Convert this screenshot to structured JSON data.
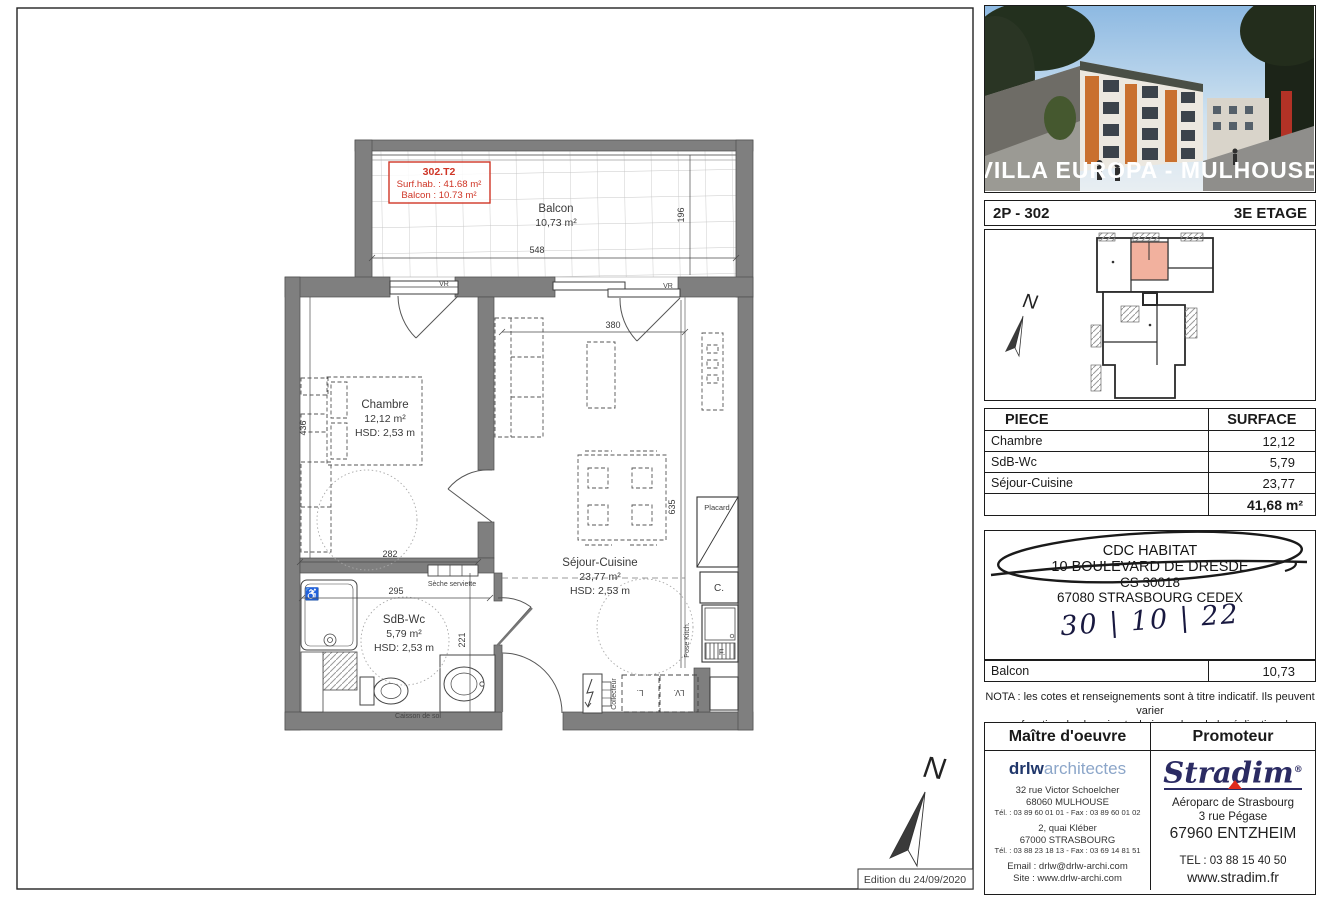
{
  "page": {
    "edition": "Edition du 24/09/2020"
  },
  "plan": {
    "tag": {
      "line1": "302.T2",
      "line2": "Surf.hab. : 41.68 m²",
      "line3": "Balcon : 10.73 m²"
    },
    "rooms": {
      "balcon": {
        "name": "Balcon",
        "area": "10,73 m²"
      },
      "chambre": {
        "name": "Chambre",
        "area": "12,12 m²",
        "hsd": "HSD: 2,53 m"
      },
      "sejour": {
        "name": "Séjour-Cuisine",
        "area": "23,77 m²",
        "hsd": "HSD: 2,53 m"
      },
      "sdb": {
        "name": "SdB-Wc",
        "area": "5,79 m²",
        "hsd": "HSD: 2,53 m"
      }
    },
    "dims": {
      "balcon_w": "548",
      "balcon_d": "196",
      "sejour_w": "380",
      "sejour_d": "635",
      "chambre_w": "282",
      "chambre_d": "436",
      "sdb_w": "295",
      "sdb_d": "221"
    },
    "labels": {
      "seche_serviette": "Sèche serviette",
      "caisson": "Caisson de sol",
      "placard": "Placard",
      "c": "C.",
      "f": "F.",
      "pose_kitch": "Pose Kitch.",
      "collecteur": "Collecteur",
      "l": "L.",
      "lv": "LV.",
      "vr": "VR",
      "north": "N"
    }
  },
  "sidebar": {
    "photo_caption": "VILLA EUROPA - MULHOUSE",
    "unit": {
      "ref": "2P - 302",
      "floor": "3E ETAGE"
    },
    "surface_table": {
      "col_piece": "PIECE",
      "col_surface": "SURFACE",
      "rows": [
        {
          "piece": "Chambre",
          "surface": "12,12"
        },
        {
          "piece": "SdB-Wc",
          "surface": "5,79"
        },
        {
          "piece": "Séjour-Cuisine",
          "surface": "23,77"
        }
      ],
      "total": "41,68 m²"
    },
    "stamp": {
      "line1": "CDC HABITAT",
      "line2": "10 BOULEVARD DE DRESDE",
      "line3": "CS 30018",
      "line4": "67080 STRASBOURG CEDEX",
      "handwritten_date": "30 | 10 | 22"
    },
    "balcon_row": {
      "label": "Balcon",
      "value": "10,73"
    },
    "nota": {
      "line1": "NOTA : les cotes et renseignements sont à titre indicatif. Ils peuvent varier",
      "line2": "en fonction des besoins techniques lors de la réalisation du bâtiment."
    },
    "contractors": {
      "maitre_header": "Maître d'oeuvre",
      "promoteur_header": "Promoteur",
      "drlw": {
        "logo_bold": "drlw",
        "logo_light": "architectes",
        "addr1_l1": "32 rue Victor Schoelcher",
        "addr1_l2": "68060 MULHOUSE",
        "addr1_tel": "Tél. : 03 89 60 01 01 - Fax : 03 89 60 01 02",
        "addr2_l1": "2, quai Kléber",
        "addr2_l2": "67000 STRASBOURG",
        "addr2_tel": "Tél. : 03 88 23 18 13 - Fax : 03 69 14 81 51",
        "email": "Email : drlw@drlw-archi.com",
        "site": "Site : www.drlw-archi.com"
      },
      "stradim": {
        "logo": "Stradim",
        "reg": "®",
        "addr_l1": "Aéroparc de Strasbourg",
        "addr_l2": "3 rue Pégase",
        "addr_l3": "67960 ENTZHEIM",
        "tel": "TEL : 03 88 15 40 50",
        "site": "www.stradim.fr"
      }
    }
  }
}
